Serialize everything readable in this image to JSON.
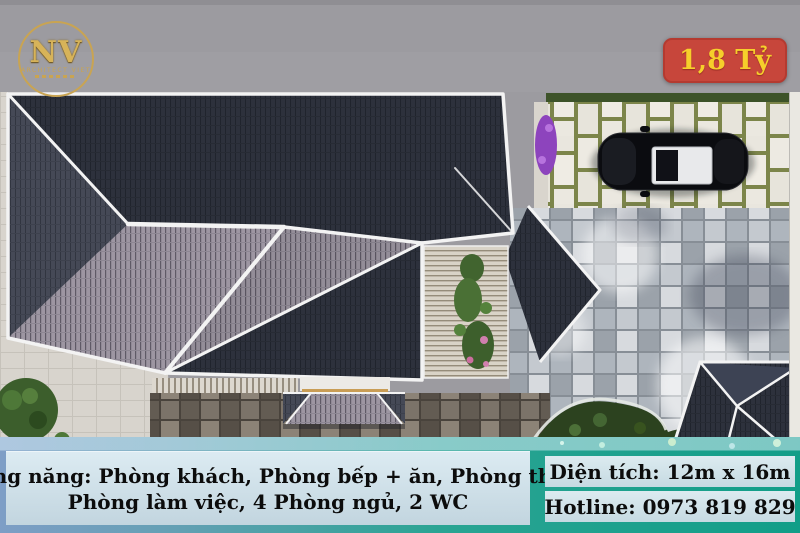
{
  "overlay": {
    "logo": {
      "monogram": "NV",
      "subtitle": "ARCHITECT VIET"
    },
    "price_badge": {
      "label": "1,8 Tỷ"
    },
    "bottom": {
      "left_line1": "Công năng: Phòng khách, Phòng bếp + ăn, Phòng thờ,",
      "left_line2": "Phòng làm việc, 4 Phòng ngủ, 2 WC",
      "area": "Diện tích: 12m x 16m",
      "hotline": "Hotline: 0973 819 829"
    }
  },
  "colors": {
    "badge_bg": "#c7463b",
    "badge_text": "#f6cf2b",
    "teal_band": "#16a18d",
    "blue_band": "#7e9ec6",
    "info_bar_bg": "#cfe2ea",
    "info_text": "#0c0c0c",
    "logo_gold": "#c9a452",
    "roof_dark": "#2d313c",
    "roof_light": "#9d96a2",
    "road_gray": "#9c9ba0",
    "paver_green_joint": "#7c854a"
  },
  "scene": {
    "view": "top-down 3D render of hip-roof house",
    "elements": [
      "main-roof",
      "courtyard-pergola",
      "porch-roof",
      "side-roof",
      "corner-roof",
      "parking-pavers",
      "car",
      "hedge",
      "purple-shrubs",
      "patio-pavers",
      "garden",
      "tree"
    ]
  }
}
